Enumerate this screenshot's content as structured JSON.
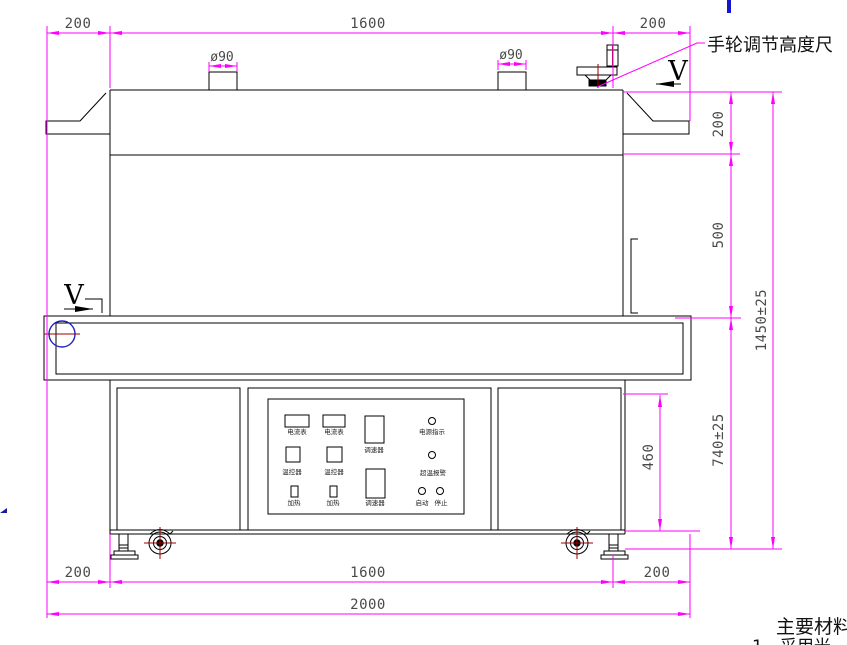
{
  "drawing": {
    "dims": {
      "top_left": "200",
      "top_mid": "1600",
      "top_right": "200",
      "stack_left": "ø90",
      "stack_right": "ø90",
      "right_upper": "200",
      "right_mid": "500",
      "right_lower": "740±25",
      "right_overall": "1450±25",
      "cabinet_height": "460",
      "bottom_left": "200",
      "bottom_mid": "1600",
      "bottom_right": "200",
      "bottom_overall": "2000"
    },
    "labels": {
      "handwheel_note": "手轮调节高度尺",
      "section_left": "V",
      "section_right": "V"
    },
    "panel": {
      "ammeter1": "电流表",
      "ammeter2": "电流表",
      "speed1": "调速器",
      "speed2": "调速器",
      "power_indicator": "电源指示",
      "temp_controller1": "温控器",
      "temp_controller2": "温控器",
      "overtemp_alarm": "超温报警",
      "heat1": "加热",
      "heat2": "加热",
      "start": "启动",
      "stop": "停止"
    },
    "notes": {
      "title": "主要材料",
      "line1": "1、采用光"
    },
    "colors": {
      "dimension_magenta": "#FF00FF",
      "outline_black": "#000000",
      "accent_blue": "#2020c8",
      "accent_dark_red": "#990000",
      "dim_text_gray": "#4a4a4a"
    }
  }
}
